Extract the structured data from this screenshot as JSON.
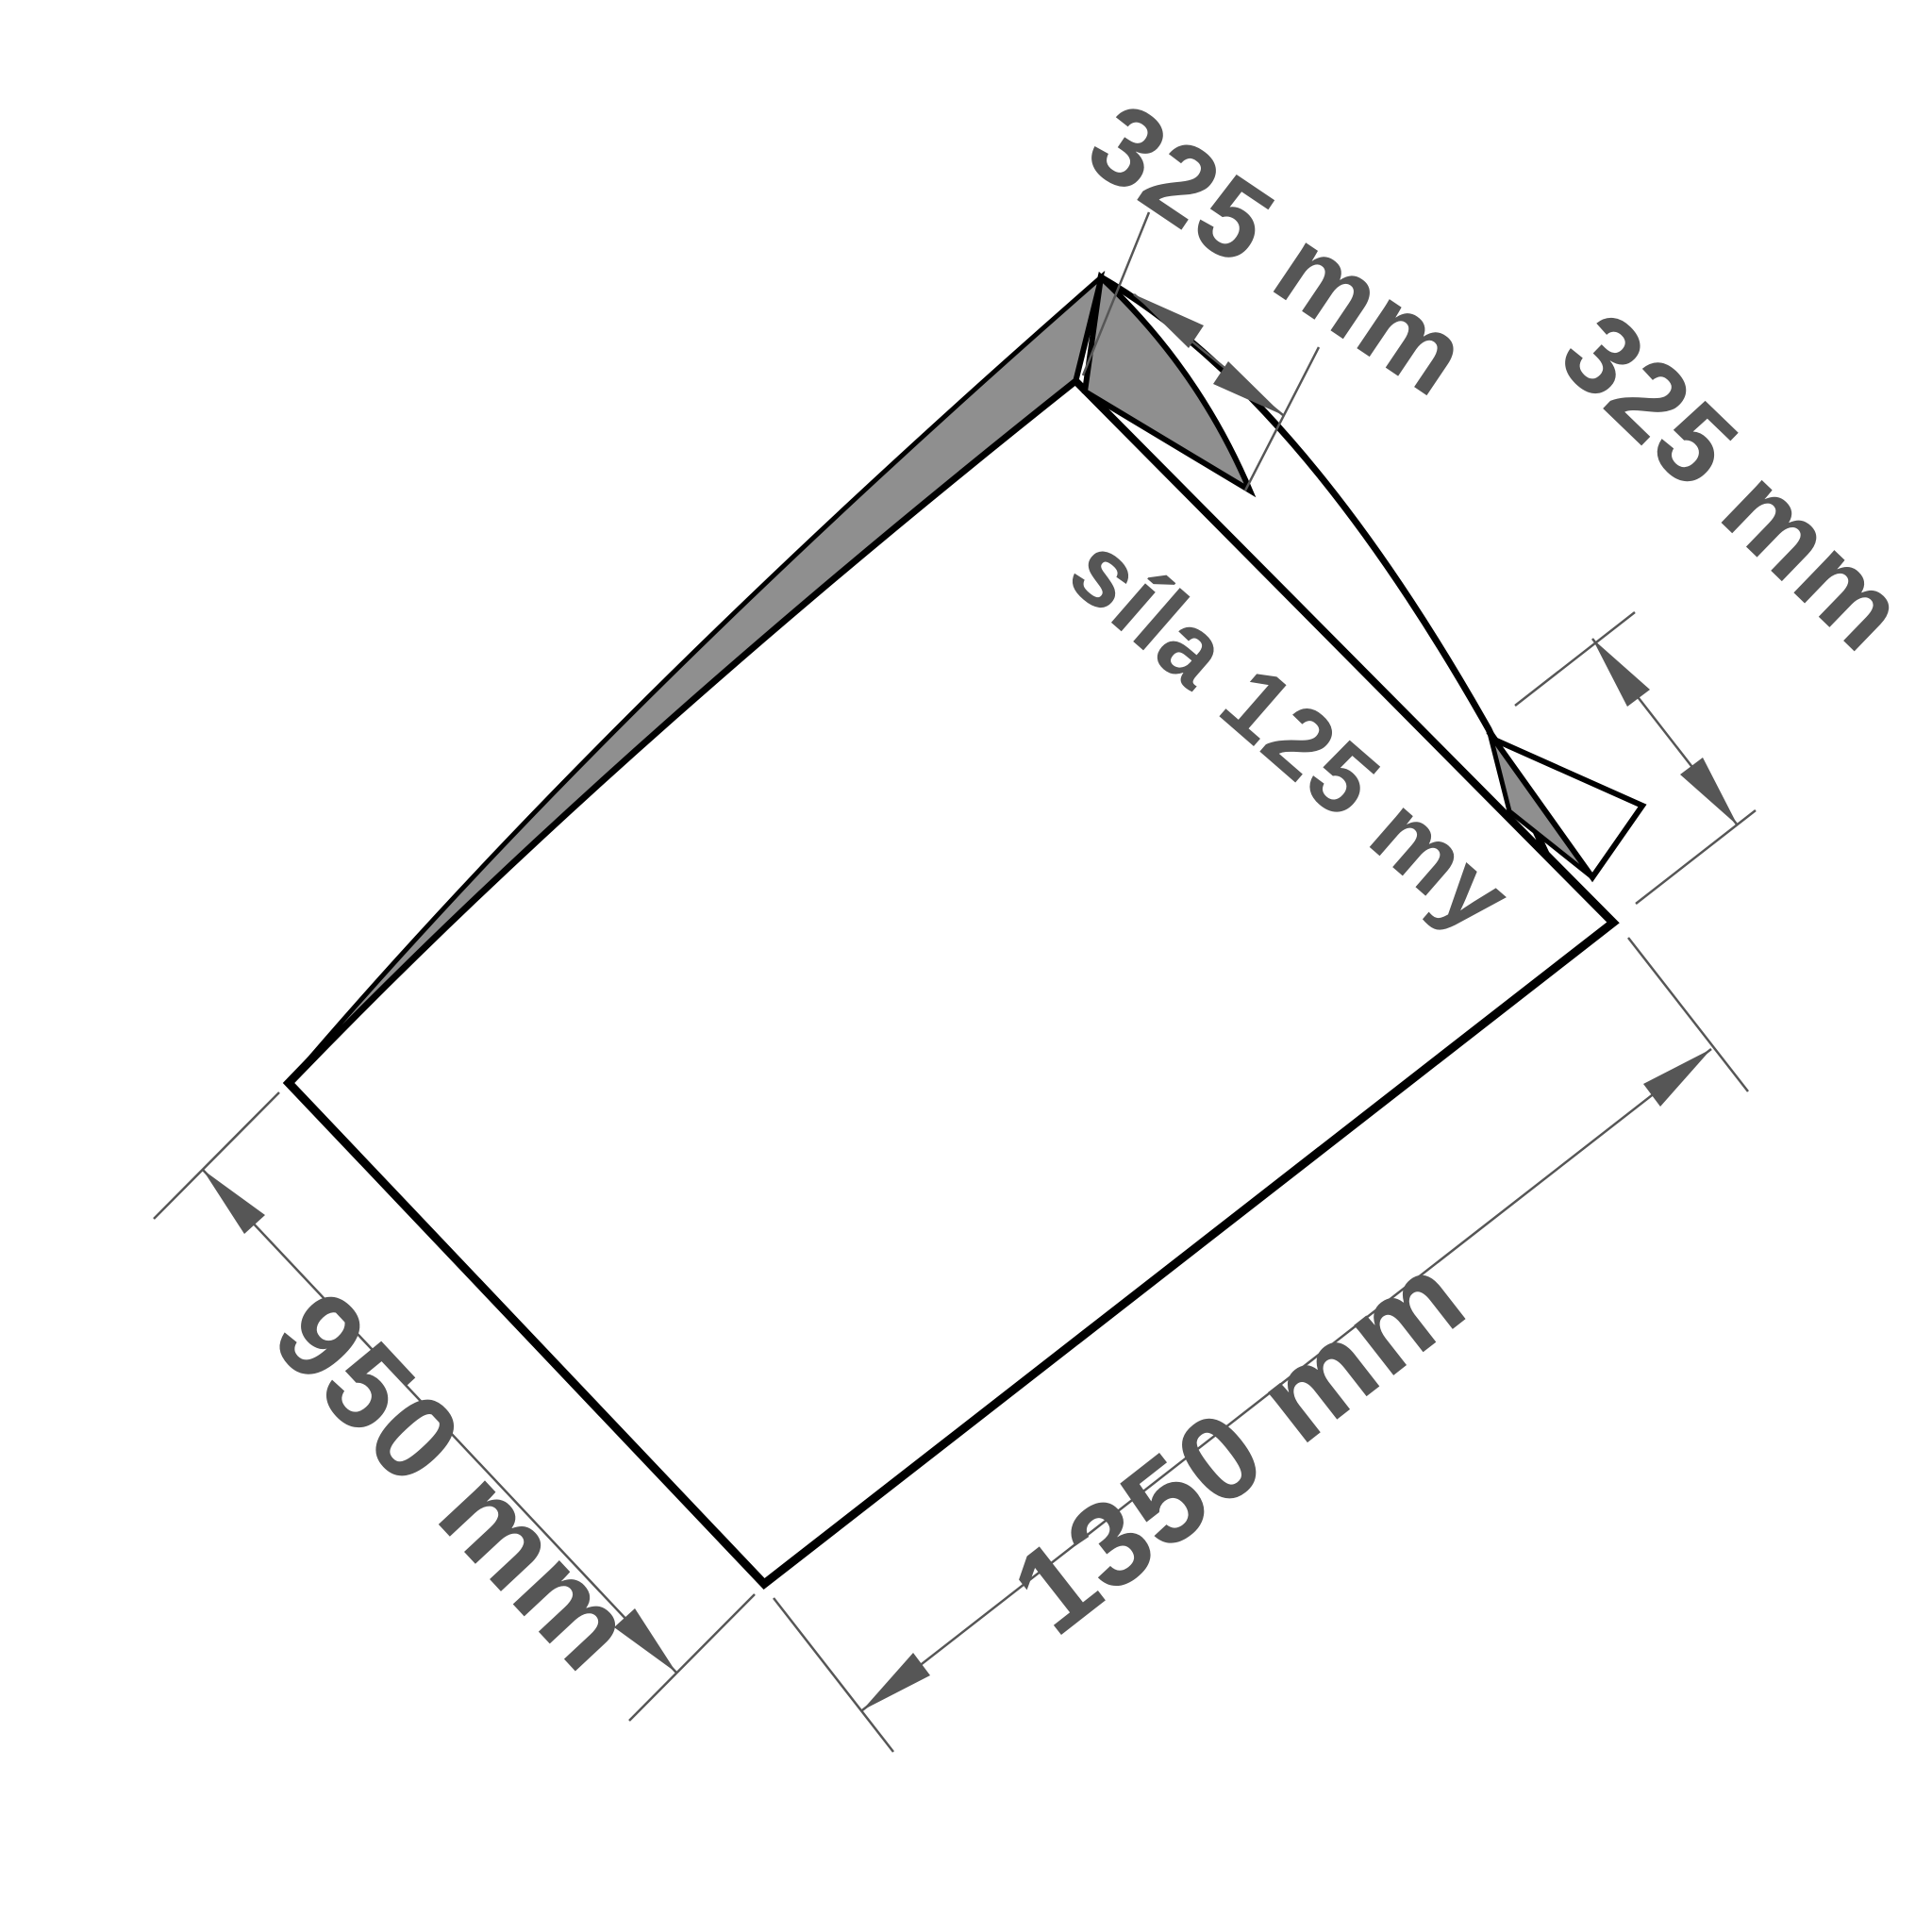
{
  "diagram": {
    "type": "technical-drawing",
    "subject": "flat plastic bag with fold-over flap, shown rotated",
    "labels": {
      "flap_top": "325 mm",
      "flap_side": "325 mm",
      "bag_width": "950 mm",
      "bag_length": "1350 mm",
      "thickness": "síla 125 my"
    },
    "colors": {
      "background": "#ffffff",
      "panel_fill": "#ffffff",
      "fold_fill": "#8f8f8f",
      "outline": "#000000",
      "annotation": "#565656"
    }
  }
}
